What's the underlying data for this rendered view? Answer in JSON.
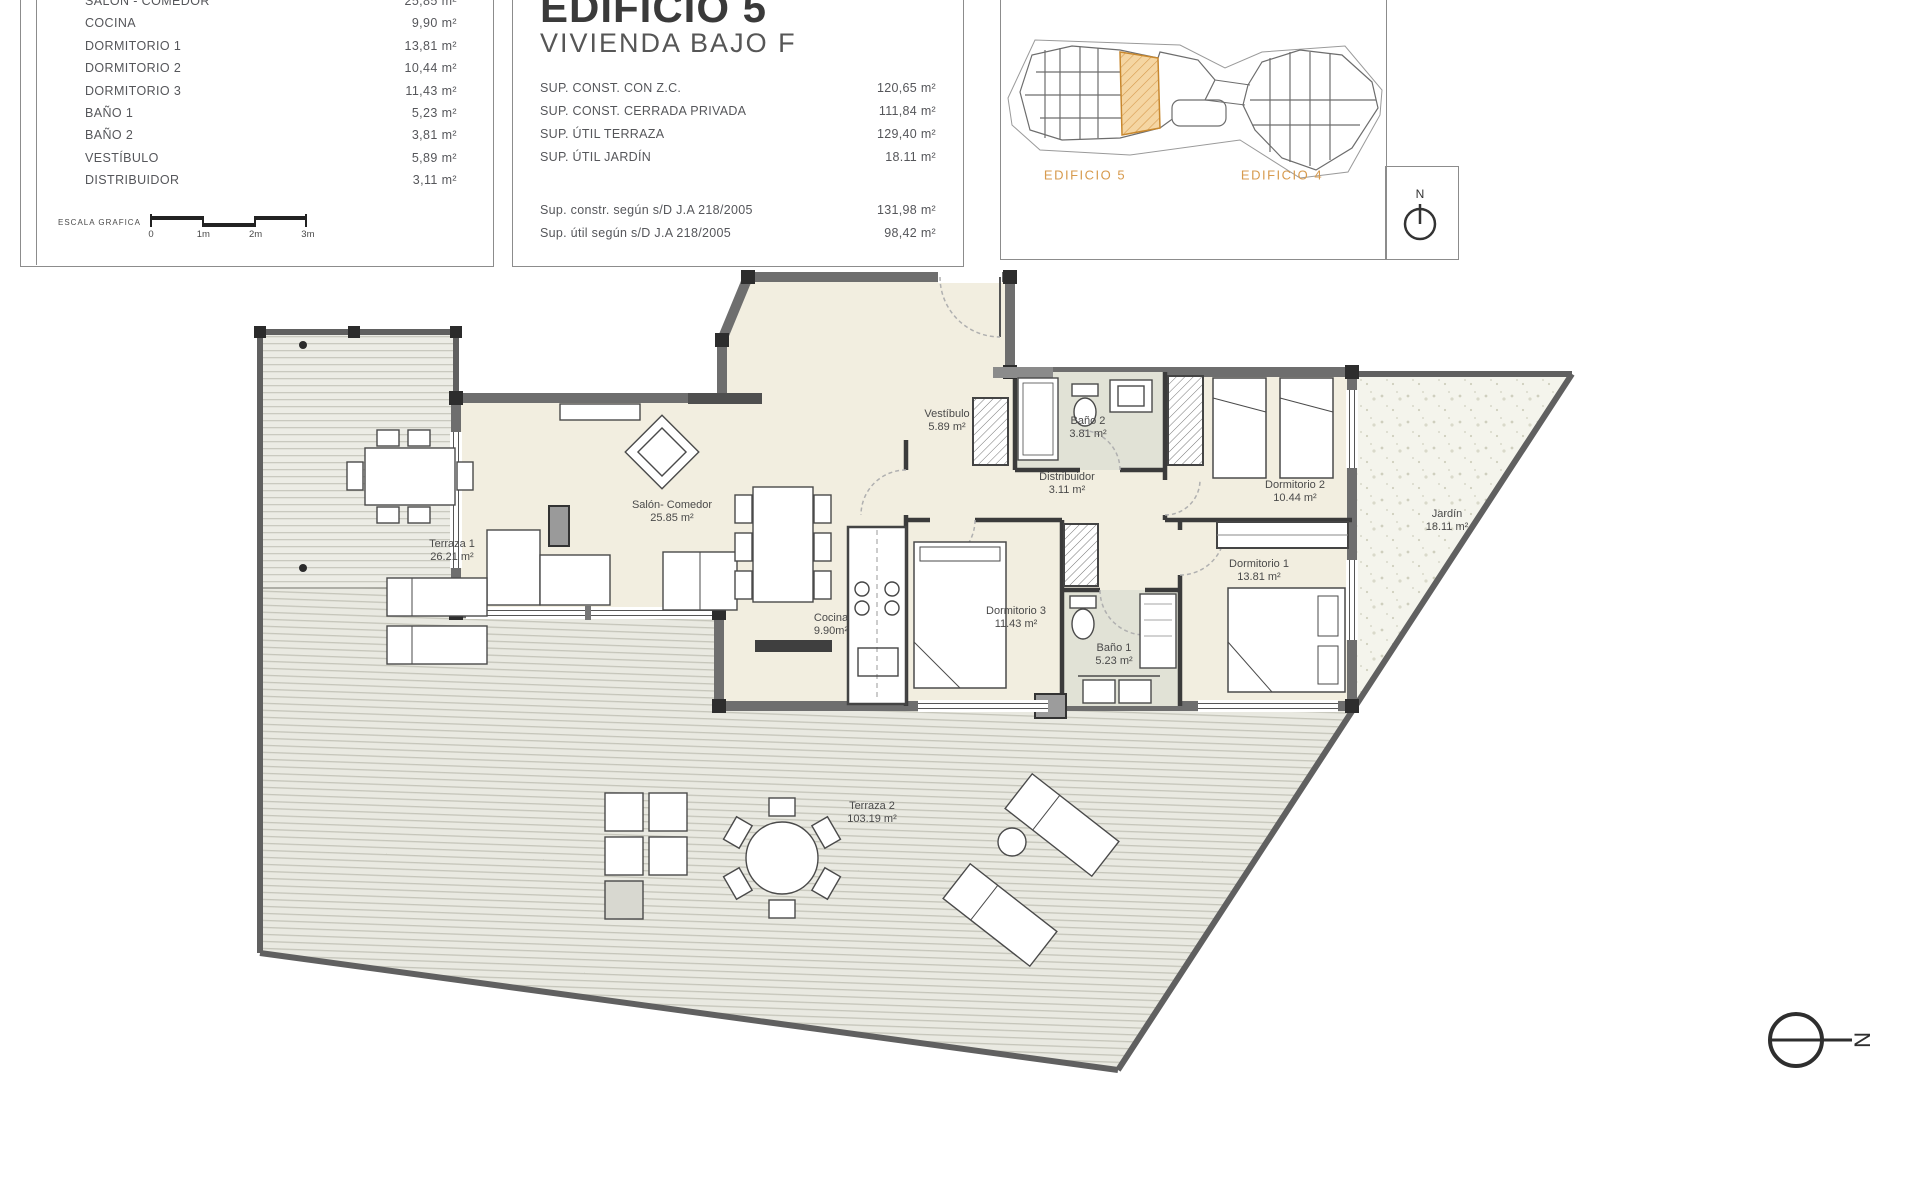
{
  "summary_table": {
    "rows": [
      {
        "label": "SALÓN - COMEDOR",
        "value": "25,85 m²"
      },
      {
        "label": "COCINA",
        "value": "9,90 m²"
      },
      {
        "label": "DORMITORIO 1",
        "value": "13,81 m²"
      },
      {
        "label": "DORMITORIO 2",
        "value": "10,44 m²"
      },
      {
        "label": "DORMITORIO 3",
        "value": "11,43 m²"
      },
      {
        "label": "BAÑO 1",
        "value": "5,23 m²"
      },
      {
        "label": "BAÑO 2",
        "value": "3,81 m²"
      },
      {
        "label": "VESTÍBULO",
        "value": "5,89 m²"
      },
      {
        "label": "DISTRIBUIDOR",
        "value": "3,11 m²"
      }
    ],
    "scale": {
      "label": "ESCALA GRAFICA",
      "ticks": [
        "0",
        "1m",
        "2m",
        "3m"
      ]
    }
  },
  "title_block": {
    "title": "EDIFICIO 5",
    "subtitle": "VIVIENDA BAJO F",
    "areas": [
      {
        "label": "SUP. CONST. CON Z.C.",
        "value": "120,65 m²"
      },
      {
        "label": "SUP. CONST. CERRADA PRIVADA",
        "value": "111,84 m²"
      },
      {
        "label": "SUP. ÚTIL TERRAZA",
        "value": "129,40 m²"
      },
      {
        "label": "SUP. ÚTIL JARDÍN",
        "value": "18.11 m²"
      }
    ],
    "legal": [
      {
        "label": "Sup. constr. según s/D J.A 218/2005",
        "value": "131,98 m²"
      },
      {
        "label": "Sup. útil según s/D J.A 218/2005",
        "value": "98,42 m²"
      }
    ]
  },
  "site_plan": {
    "left_building_label": "EDIFICIO 5",
    "right_building_label": "EDIFICIO 4",
    "north_letter": "N",
    "accent_color": "#d79a4d"
  },
  "plan": {
    "north_letter": "N",
    "labels": [
      {
        "name": "Terraza 1",
        "area": "26.21 m²",
        "x": 452,
        "y": 551
      },
      {
        "name": "Salón- Comedor",
        "area": "25.85 m²",
        "x": 672,
        "y": 512
      },
      {
        "name": "Vestíbulo",
        "area": "5.89 m²",
        "x": 947,
        "y": 421
      },
      {
        "name": "Baño 2",
        "area": "3.81 m²",
        "x": 1088,
        "y": 428
      },
      {
        "name": "Dormitorio 2",
        "area": "10.44 m²",
        "x": 1295,
        "y": 492
      },
      {
        "name": "Distribuidor",
        "area": "3.11 m²",
        "x": 1067,
        "y": 484
      },
      {
        "name": "Cocina",
        "area": "9.90m²",
        "x": 831,
        "y": 625
      },
      {
        "name": "Dormitorio 3",
        "area": "11.43 m²",
        "x": 1016,
        "y": 618
      },
      {
        "name": "Baño 1",
        "area": "5.23 m²",
        "x": 1114,
        "y": 655
      },
      {
        "name": "Dormitorio 1",
        "area": "13.81 m²",
        "x": 1259,
        "y": 571
      },
      {
        "name": "Jardín",
        "area": "18.11 m²",
        "x": 1447,
        "y": 521
      },
      {
        "name": "Terraza 2",
        "area": "103.19 m²",
        "x": 872,
        "y": 813
      }
    ]
  },
  "colors": {
    "accent_orange": "#d79a4d",
    "room_fill": "#f2eee0",
    "bath_fill": "#e1e2d6",
    "wall_gray": "#6e6e6e"
  }
}
